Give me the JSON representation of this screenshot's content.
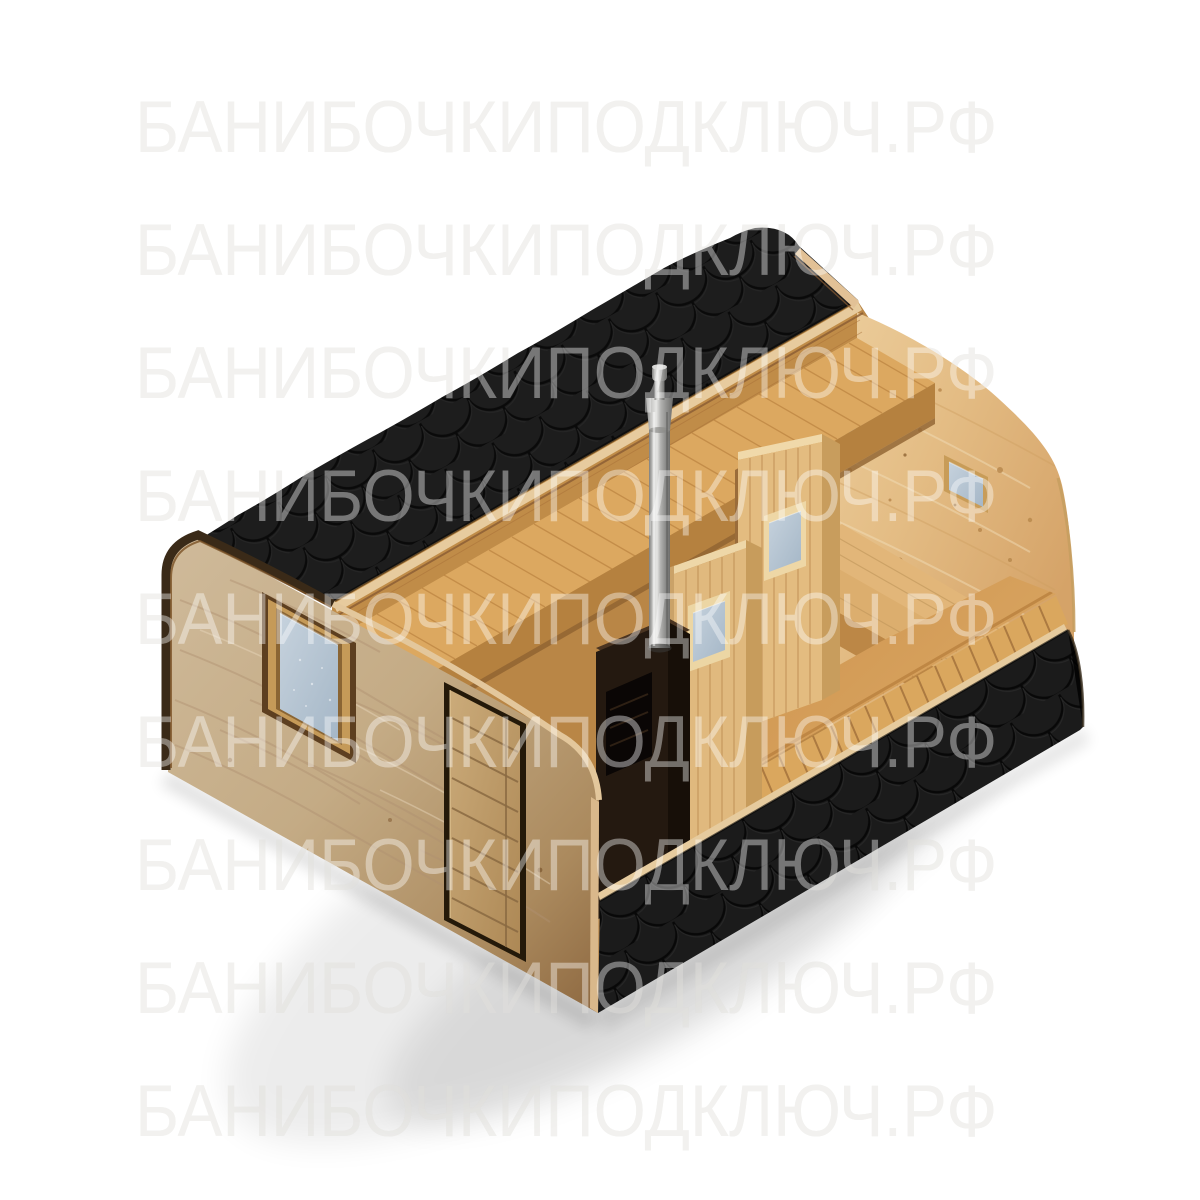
{
  "page": {
    "background_color": "#ffffff",
    "width": 1200,
    "height": 1200
  },
  "watermark": {
    "text": "БАНИБОЧКИПОДКЛЮЧ.РФ",
    "repeat_rows": 9,
    "tone_on_white": "#e9e8e4",
    "tone_on_image": "rgba(255,255,255,0.40)"
  },
  "scene": {
    "type": "3d-product-render-cutaway",
    "subject": "Квадро баня-бочка — quadro barrel sauna shown with roof and side wall cut away",
    "parts": [
      {
        "name": "roof-shingles",
        "label": "black fish-scale bitumen shingle roof",
        "color": "#1d1d1d"
      },
      {
        "name": "front-wall",
        "label": "front end wall of light spruce with rounded corners",
        "color": "#c6ac87"
      },
      {
        "name": "front-window",
        "label": "square window with wooden frame",
        "frame_color": "#5d3f20",
        "glass_color": "#b6c5d3"
      },
      {
        "name": "front-door",
        "label": "wooden plank entrance door",
        "color": "#c29c6b"
      },
      {
        "name": "side-wall-shingles",
        "label": "cut-away side wall clad with black shingles",
        "color": "#1c1c1c"
      },
      {
        "name": "gable-wall",
        "label": "far end wall interior face with two small windows",
        "color": "#e6c48f"
      },
      {
        "name": "interior-floor",
        "label": "wooden plank floor",
        "color": "#cf9852"
      },
      {
        "name": "interior-benches",
        "label": "tiered wooden benches and sleeping platform",
        "color": "#dca860"
      },
      {
        "name": "partition-walls",
        "label": "two interior partition walls with small frosted windows",
        "color": "#e0b97e"
      },
      {
        "name": "sauna-stove",
        "label": "dark wood-burning sauna stove with vent grille",
        "color": "#241910"
      },
      {
        "name": "chimney",
        "label": "stainless steel chimney pipe with cap",
        "color": "#b9b9b7"
      }
    ]
  }
}
